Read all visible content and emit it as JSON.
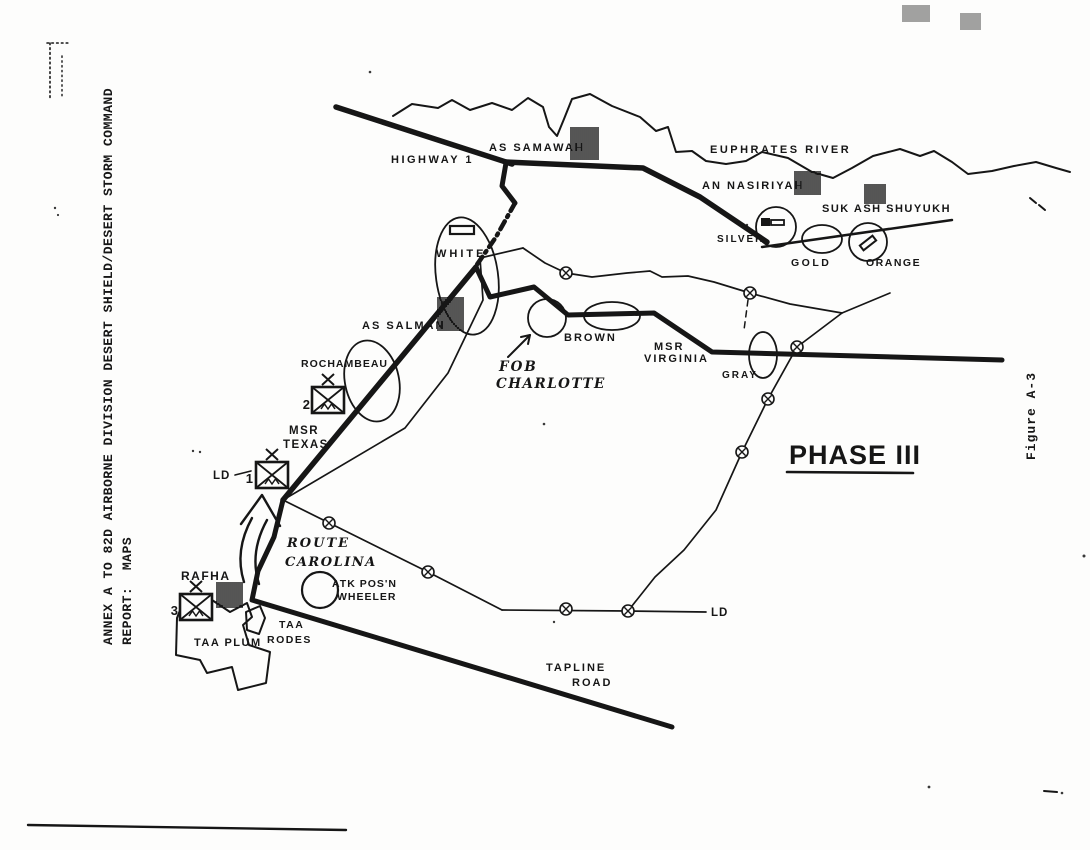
{
  "page": {
    "annex_title_line1": "ANNEX A TO 82D AIRBORNE DIVISION DESERT SHIELD/DESERT STORM COMMAND",
    "annex_title_line2": "REPORT:  MAPS",
    "figure_caption": "Figure A-3",
    "phase_label": "PHASE III"
  },
  "map": {
    "labels": {
      "highway_1": "HIGHWAY 1",
      "as_samawah": "AS SAMAWAH",
      "euphrates_river": "EUPHRATES RIVER",
      "an_nasiriyah": "AN NASIRIYAH",
      "suk_ash_shuyukh": "SUK ASH SHUYUKH",
      "obj_silver": "SILVER",
      "obj_gold": "GOLD",
      "obj_orange": "ORANGE",
      "obj_white": "WHITE",
      "as_salman": "AS SALMAN",
      "obj_brown": "BROWN",
      "fob_line1": "FOB",
      "fob_line2": "CHARLOTTE",
      "msr_virginia_line1": "MSR",
      "msr_virginia_line2": "VIRGINIA",
      "obj_gray": "GRAY",
      "obj_rochambeau": "ROCHAMBEAU",
      "msr_texas_line1": "MSR",
      "msr_texas_line2": "TEXAS",
      "ld_west": "LD",
      "ld_east": "LD",
      "route_carolina_line1": "ROUTE",
      "route_carolina_line2": "CAROLINA",
      "atk_posn_line1": "ATK POS'N",
      "atk_posn_line2": "WHEELER",
      "rafha": "RAFHA",
      "taa_plum": "TAA PLUM",
      "taa_rodes_line1": "TAA",
      "taa_rodes_line2": "RODES",
      "tapline_road_line1": "TAPLINE",
      "tapline_road_line2": "ROAD"
    },
    "unit_numbers": {
      "brigade_1": "1",
      "brigade_2": "2",
      "brigade_3": "3"
    }
  },
  "colors": {
    "ink": "#161616",
    "paper": "#fdfdfc"
  }
}
